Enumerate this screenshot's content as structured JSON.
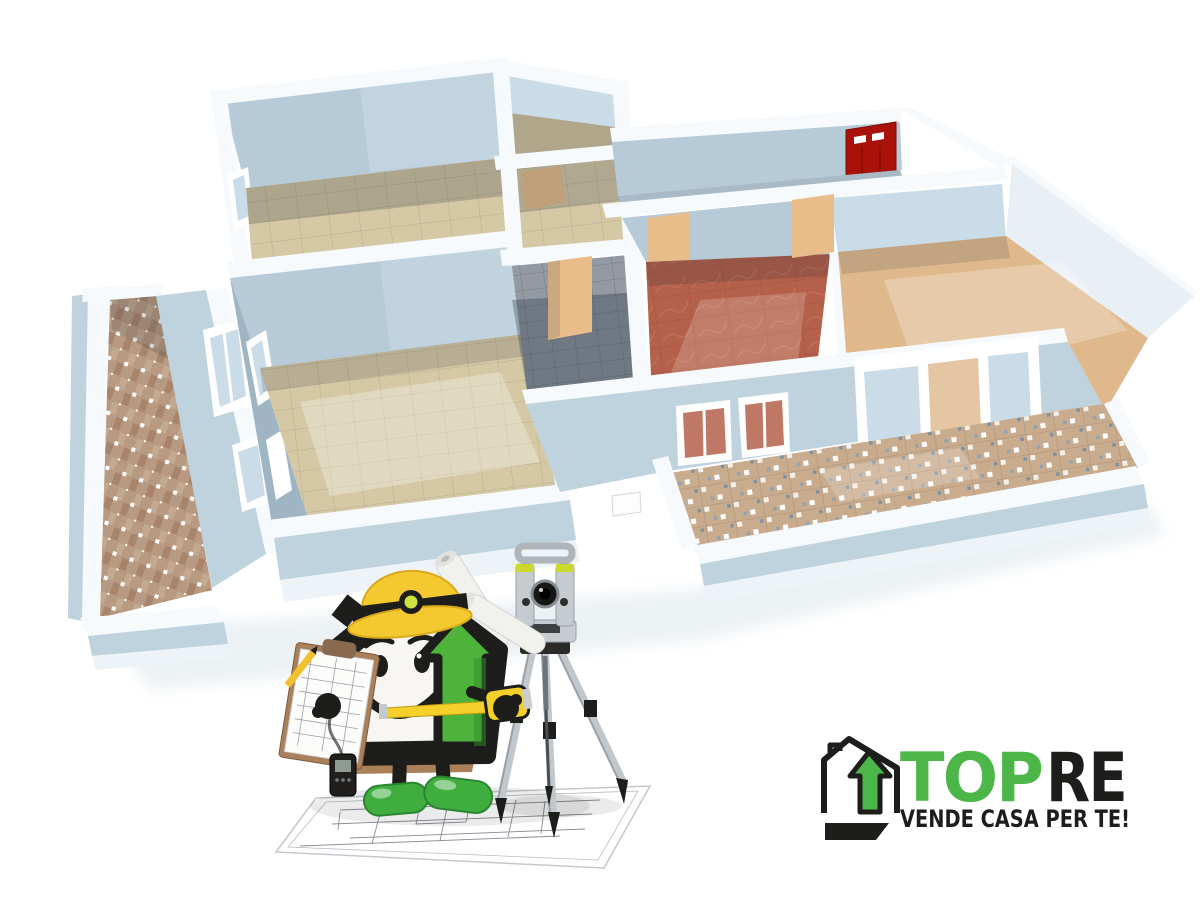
{
  "logo": {
    "brand_top": "TOP",
    "brand_re": "RE",
    "tagline": "VENDE CASA PER TE!"
  },
  "palette": {
    "wallTop": "#f7fafc",
    "wallInt": "#b6cad7",
    "wallIntLight": "#cadce7",
    "wallIntDark": "#9fb5c3",
    "wallExt": "#bfd3df",
    "wallExtLight": "#d3e2ea",
    "slab": "#eef3f7",
    "floorTan": "#d5c8a5",
    "floorTanShadow": "#b0a68a",
    "floorOrange": "#dfb88c",
    "terracotta": "#b4604a",
    "grayTile": "#949aa3",
    "doorTan": "#e8bd8a",
    "redDoor": "#a81208",
    "logoGreen": "#4cb648",
    "mascotGreen": "#4db33a",
    "hatYellow": "#f3c92f",
    "tapeYellow": "#f5d02a",
    "shoeGreen": "#3fae3f",
    "balconyTile": "#c9ab8e",
    "weaveTile": "#b79a81",
    "metal": "#c6cbd0",
    "black": "#1d1d1b"
  },
  "icons": {
    "floorplan": "isometric-3d-floorplan",
    "red_door": "red-entry-door",
    "mascot": "house-surveyor-mascot",
    "instrument": "total-station-tripod",
    "blueprint": "blueprint-sheet",
    "logo_mark": "house-arrow-logo"
  }
}
